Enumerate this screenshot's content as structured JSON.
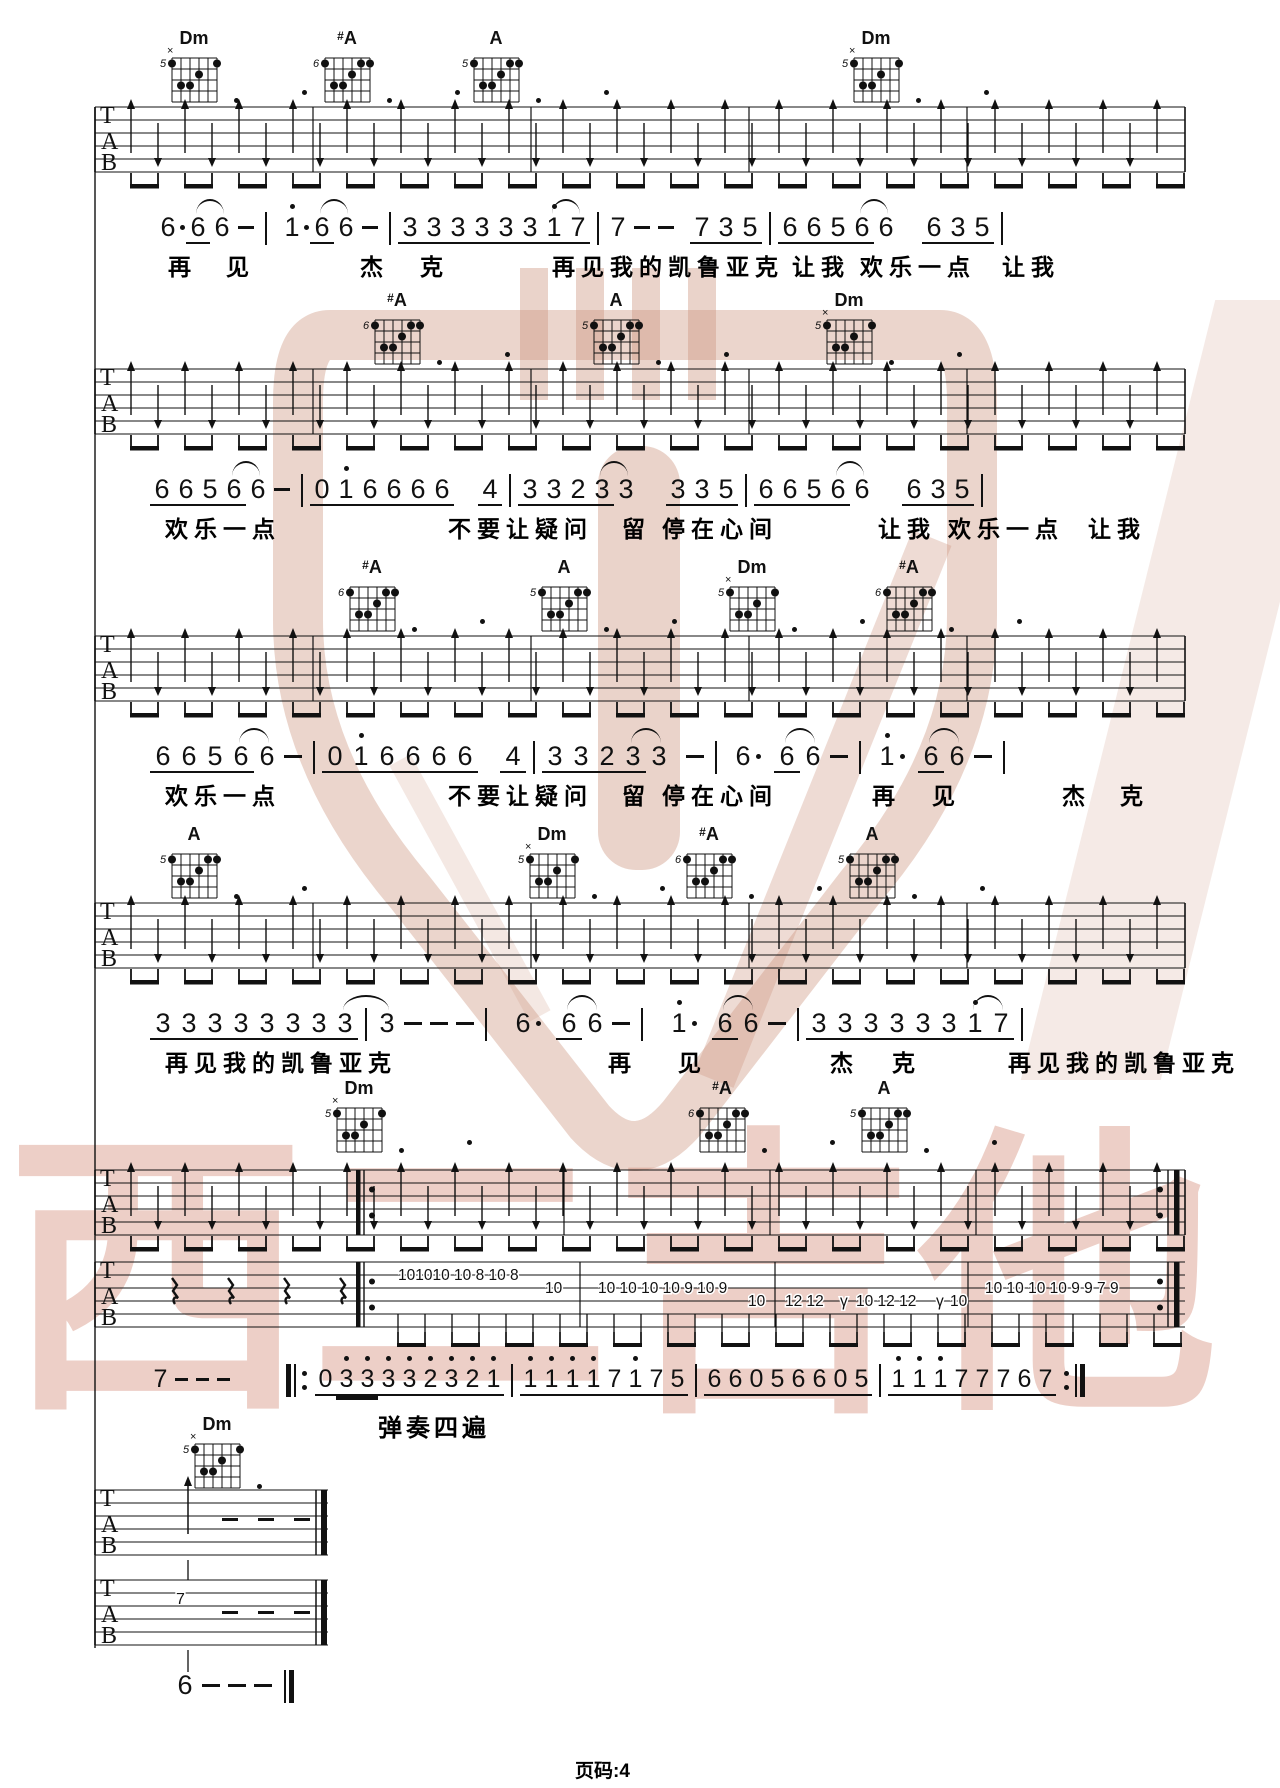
{
  "page": {
    "footer": "页码:4",
    "play_instruction": "弹奏四遍"
  },
  "watermark": {
    "brand_text": "西二吉他"
  },
  "colors": {
    "ink": "#111111",
    "wm_text": "rgba(208,130,108,0.38)",
    "wm_logo": "rgba(205,150,128,0.40)"
  },
  "tab_letters": [
    "T",
    "A",
    "B"
  ],
  "chord_shapes": {
    "Dm": {
      "label": "Dm",
      "fret": "5",
      "muted": true,
      "dots": [
        [
          1,
          1
        ],
        [
          6,
          1
        ],
        [
          4,
          2
        ],
        [
          2,
          3
        ],
        [
          3,
          3
        ]
      ]
    },
    "#A": {
      "label": "#A",
      "fret": "6",
      "muted": false,
      "dots": [
        [
          1,
          1
        ],
        [
          5,
          1
        ],
        [
          6,
          1
        ],
        [
          4,
          2
        ],
        [
          2,
          3
        ],
        [
          3,
          3
        ]
      ]
    },
    "A": {
      "label": "A",
      "fret": "5",
      "muted": false,
      "dots": [
        [
          1,
          1
        ],
        [
          5,
          1
        ],
        [
          6,
          1
        ],
        [
          4,
          2
        ],
        [
          2,
          3
        ],
        [
          3,
          3
        ]
      ]
    }
  },
  "systems": [
    {
      "chord_y": 28,
      "tab_y": 107,
      "not_y": 212,
      "lyr_y": 248,
      "tok_w": 24,
      "chords": [
        {
          "n": "Dm",
          "x": 190
        },
        {
          "n": "#A",
          "x": 343
        },
        {
          "n": "A",
          "x": 492
        },
        {
          "n": "Dm",
          "x": 872
        }
      ],
      "tok": [
        {
          "g": "6",
          "d": 1
        },
        {
          "g": "6",
          "u": 1,
          "tie": 1
        },
        {
          "g": "6"
        },
        {
          "g": "-"
        },
        {
          "b": "|"
        },
        {
          "g": "1",
          "h": 1,
          "d": 1
        },
        {
          "g": "6",
          "u": 1,
          "tie": 1
        },
        {
          "g": "6"
        },
        {
          "g": "-"
        },
        {
          "b": "|"
        },
        {
          "g": "3",
          "u": 1
        },
        {
          "g": "3",
          "u": 1
        },
        {
          "g": "3",
          "u": 1
        },
        {
          "g": "3",
          "u": 1
        },
        {
          "g": "3",
          "u": 1
        },
        {
          "g": "3",
          "u": 1
        },
        {
          "g": "1",
          "h": 1,
          "u": 1,
          "tie": 1
        },
        {
          "g": "7",
          "u": 1
        },
        {
          "b": "|"
        },
        {
          "g": "7"
        },
        {
          "g": "-"
        },
        {
          "g": "-"
        },
        {
          "g": "7",
          "u": 1,
          "gap": 12
        },
        {
          "g": "3",
          "u": 1
        },
        {
          "g": "5",
          "u": 1
        },
        {
          "b": "|"
        },
        {
          "g": "6",
          "u": 1
        },
        {
          "g": "6",
          "u": 1
        },
        {
          "g": "5",
          "u": 1
        },
        {
          "g": "6",
          "u": 1,
          "tie": 1
        },
        {
          "g": "6"
        },
        {
          "g": "6",
          "u": 1,
          "gap": 24
        },
        {
          "g": "3",
          "u": 1
        },
        {
          "g": "5",
          "u": 1
        },
        {
          "b": "|"
        }
      ],
      "lyr": [
        [
          168,
          "再"
        ],
        [
          226,
          "见"
        ],
        [
          360,
          "杰"
        ],
        [
          420,
          "克"
        ],
        [
          552,
          "再见我的凯鲁亚克"
        ],
        [
          792,
          "让我"
        ],
        [
          860,
          "欢乐一点"
        ],
        [
          1002,
          "让我"
        ]
      ]
    },
    {
      "chord_y": 290,
      "tab_y": 369,
      "not_y": 474,
      "lyr_y": 510,
      "tok_w": 24,
      "chords": [
        {
          "n": "#A",
          "x": 393
        },
        {
          "n": "A",
          "x": 612
        },
        {
          "n": "Dm",
          "x": 845
        }
      ],
      "tok": [
        {
          "g": "6",
          "u": 1
        },
        {
          "g": "6",
          "u": 1
        },
        {
          "g": "5",
          "u": 1
        },
        {
          "g": "6",
          "u": 1,
          "tie": 1
        },
        {
          "g": "6"
        },
        {
          "g": "-"
        },
        {
          "b": "|"
        },
        {
          "g": "0",
          "u": 1
        },
        {
          "g": "1",
          "h": 1,
          "u": 1
        },
        {
          "g": "6",
          "u": 1
        },
        {
          "g": "6",
          "u": 1
        },
        {
          "g": "6",
          "u": 1
        },
        {
          "g": "6",
          "u": 1
        },
        {
          "g": "4",
          "u": 1,
          "gap": 24
        },
        {
          "b": "|"
        },
        {
          "g": "3",
          "u": 1
        },
        {
          "g": "3",
          "u": 1
        },
        {
          "g": "2",
          "u": 1
        },
        {
          "g": "3",
          "u": 1,
          "tie": 1
        },
        {
          "g": "3"
        },
        {
          "g": "3",
          "u": 1,
          "gap": 28
        },
        {
          "g": "3",
          "u": 1
        },
        {
          "g": "5",
          "u": 1
        },
        {
          "b": "|"
        },
        {
          "g": "6",
          "u": 1
        },
        {
          "g": "6",
          "u": 1
        },
        {
          "g": "5",
          "u": 1
        },
        {
          "g": "6",
          "u": 1,
          "tie": 1
        },
        {
          "g": "6"
        },
        {
          "g": "6",
          "u": 1,
          "gap": 28
        },
        {
          "g": "3",
          "u": 1
        },
        {
          "g": "5",
          "u": 1
        },
        {
          "b": "|"
        }
      ],
      "lyr": [
        [
          165,
          "欢乐一点"
        ],
        [
          448,
          "不要让疑问"
        ],
        [
          622,
          "留"
        ],
        [
          662,
          "停在心间"
        ],
        [
          878,
          "让我"
        ],
        [
          948,
          "欢乐一点"
        ],
        [
          1088,
          "让我"
        ]
      ]
    },
    {
      "chord_y": 557,
      "tab_y": 636,
      "not_y": 741,
      "lyr_y": 777,
      "tok_w": 26,
      "chords": [
        {
          "n": "#A",
          "x": 368
        },
        {
          "n": "A",
          "x": 560
        },
        {
          "n": "Dm",
          "x": 748
        },
        {
          "n": "#A",
          "x": 905
        }
      ],
      "tok": [
        {
          "g": "6",
          "u": 1
        },
        {
          "g": "6",
          "u": 1
        },
        {
          "g": "5",
          "u": 1
        },
        {
          "g": "6",
          "u": 1,
          "tie": 1
        },
        {
          "g": "6"
        },
        {
          "g": "-"
        },
        {
          "b": "|"
        },
        {
          "g": "0",
          "u": 1
        },
        {
          "g": "1",
          "h": 1,
          "u": 1
        },
        {
          "g": "6",
          "u": 1
        },
        {
          "g": "6",
          "u": 1
        },
        {
          "g": "6",
          "u": 1
        },
        {
          "g": "6",
          "u": 1
        },
        {
          "g": "4",
          "u": 1,
          "gap": 22
        },
        {
          "b": "|"
        },
        {
          "g": "3",
          "u": 1
        },
        {
          "g": "3",
          "u": 1
        },
        {
          "g": "2",
          "u": 1
        },
        {
          "g": "3",
          "u": 1,
          "tie": 1
        },
        {
          "g": "3"
        },
        {
          "g": "-",
          "gap": 10
        },
        {
          "b": "|"
        },
        {
          "g": "6",
          "d": 1
        },
        {
          "g": "6",
          "u": 1,
          "tie": 1,
          "gap": 12
        },
        {
          "g": "6"
        },
        {
          "g": "-"
        },
        {
          "b": "|"
        },
        {
          "g": "1",
          "h": 1,
          "d": 1
        },
        {
          "g": "6",
          "u": 1,
          "tie": 1,
          "gap": 12
        },
        {
          "g": "6"
        },
        {
          "g": "-"
        },
        {
          "b": "|"
        }
      ],
      "lyr": [
        [
          165,
          "欢乐一点"
        ],
        [
          448,
          "不要让疑问"
        ],
        [
          622,
          "留"
        ],
        [
          662,
          "停在心间"
        ],
        [
          872,
          "再"
        ],
        [
          932,
          "见"
        ],
        [
          1062,
          "杰"
        ],
        [
          1120,
          "克"
        ]
      ]
    },
    {
      "chord_y": 824,
      "tab_y": 903,
      "not_y": 1008,
      "lyr_y": 1044,
      "tok_w": 26,
      "chords": [
        {
          "n": "A",
          "x": 190
        },
        {
          "n": "Dm",
          "x": 548
        },
        {
          "n": "#A",
          "x": 705
        },
        {
          "n": "A",
          "x": 868
        }
      ],
      "tok": [
        {
          "g": "3",
          "u": 1
        },
        {
          "g": "3",
          "u": 1
        },
        {
          "g": "3",
          "u": 1
        },
        {
          "g": "3",
          "u": 1
        },
        {
          "g": "3",
          "u": 1
        },
        {
          "g": "3",
          "u": 1
        },
        {
          "g": "3",
          "u": 1
        },
        {
          "g": "3",
          "u": 1,
          "tie": 1
        },
        {
          "b": "|"
        },
        {
          "g": "3"
        },
        {
          "g": "-"
        },
        {
          "g": "-"
        },
        {
          "g": "-"
        },
        {
          "b": "|"
        },
        {
          "g": "6",
          "d": 1,
          "gap": 10
        },
        {
          "g": "6",
          "u": 1,
          "tie": 1,
          "gap": 14
        },
        {
          "g": "6"
        },
        {
          "g": "-"
        },
        {
          "b": "|"
        },
        {
          "g": "1",
          "h": 1,
          "d": 1,
          "gap": 10
        },
        {
          "g": "6",
          "u": 1,
          "tie": 1,
          "gap": 14
        },
        {
          "g": "6"
        },
        {
          "g": "-"
        },
        {
          "b": "|"
        },
        {
          "g": "3",
          "u": 1
        },
        {
          "g": "3",
          "u": 1
        },
        {
          "g": "3",
          "u": 1
        },
        {
          "g": "3",
          "u": 1
        },
        {
          "g": "3",
          "u": 1
        },
        {
          "g": "3",
          "u": 1
        },
        {
          "g": "1",
          "h": 1,
          "u": 1,
          "tie": 1
        },
        {
          "g": "7",
          "u": 1
        },
        {
          "b": "|"
        }
      ],
      "lyr": [
        [
          165,
          "再见我的凯鲁亚克"
        ],
        [
          608,
          "再"
        ],
        [
          678,
          "见"
        ],
        [
          830,
          "杰"
        ],
        [
          892,
          "克"
        ],
        [
          1008,
          "再见我的凯鲁亚克"
        ]
      ]
    },
    {
      "chord_y": 1078,
      "tab_y": 1170,
      "not_y": 1364,
      "lyr_y": 0,
      "tok_w": 21,
      "tab_repeat": true,
      "chords": [
        {
          "n": "Dm",
          "x": 355
        },
        {
          "n": "#A",
          "x": 718
        },
        {
          "n": "A",
          "x": 880
        }
      ],
      "tok": [
        {
          "g": "7"
        },
        {
          "g": "-"
        },
        {
          "g": "-"
        },
        {
          "g": "-"
        },
        {
          "b": "|:",
          "gap": 52
        },
        {
          "g": "0",
          "u": 1
        },
        {
          "g": "3",
          "h": 1,
          "u": 2
        },
        {
          "g": "3",
          "h": 1,
          "u": 2
        },
        {
          "g": "3",
          "h": 1,
          "u": 1
        },
        {
          "g": "3",
          "h": 1,
          "u": 1
        },
        {
          "g": "2",
          "h": 1,
          "u": 1
        },
        {
          "g": "3",
          "h": 1,
          "u": 1
        },
        {
          "g": "2",
          "h": 1,
          "u": 1
        },
        {
          "g": "1",
          "h": 1,
          "u": 1
        },
        {
          "b": "|"
        },
        {
          "g": "1",
          "h": 1,
          "u": 1
        },
        {
          "g": "1",
          "h": 1,
          "u": 1
        },
        {
          "g": "1",
          "h": 1,
          "u": 1
        },
        {
          "g": "1",
          "h": 1,
          "u": 1
        },
        {
          "g": "7",
          "u": 1
        },
        {
          "g": "1",
          "h": 1,
          "u": 1
        },
        {
          "g": "7",
          "u": 1
        },
        {
          "g": "5",
          "u": 1
        },
        {
          "b": "|"
        },
        {
          "g": "6",
          "u": 1
        },
        {
          "g": "6",
          "u": 1
        },
        {
          "g": "0",
          "u": 1
        },
        {
          "g": "5",
          "u": 1
        },
        {
          "g": "6",
          "u": 1
        },
        {
          "g": "6",
          "u": 1
        },
        {
          "g": "0",
          "u": 1
        },
        {
          "g": "5",
          "u": 1
        },
        {
          "b": "|"
        },
        {
          "g": "1",
          "h": 1,
          "u": 1
        },
        {
          "g": "1",
          "h": 1,
          "u": 1
        },
        {
          "g": "1",
          "h": 1,
          "u": 1
        },
        {
          "g": "7",
          "u": 1
        },
        {
          "g": "7",
          "u": 1
        },
        {
          "g": "7",
          "u": 1
        },
        {
          "g": "6",
          "u": 1
        },
        {
          "g": "7",
          "u": 1
        },
        {
          "b": ":|"
        }
      ],
      "lyr": []
    }
  ],
  "melody_tab": {
    "top": 1262,
    "bars": [
      580,
      775,
      968
    ],
    "repeat_in": 358,
    "repeat_out": true,
    "rests": [
      172,
      228,
      284,
      340
    ],
    "items": [
      [
        398,
        1,
        "101010 10 8 10 8"
      ],
      [
        545,
        2,
        "10"
      ],
      [
        598,
        2,
        "10 10 10 10 9 10 9"
      ],
      [
        748,
        3,
        "10"
      ],
      [
        785,
        3,
        "12 12"
      ],
      [
        840,
        3,
        "γ"
      ],
      [
        856,
        3,
        "10 12 12"
      ],
      [
        936,
        3,
        "γ"
      ],
      [
        950,
        3,
        "10"
      ],
      [
        985,
        2,
        "10 10 10 10 9 9 7 9"
      ]
    ]
  },
  "tail": {
    "chord": {
      "n": "Dm",
      "x": 213,
      "y": 1414
    },
    "staff1": {
      "top": 1490,
      "arrow_x": 188,
      "dashes": [
        222,
        258,
        294
      ]
    },
    "staff2": {
      "top": 1580,
      "seven": "7",
      "seven_x": 176,
      "dashes": [
        222,
        258,
        294
      ]
    },
    "end_x": 172,
    "end_y": 1670,
    "end_tok": [
      {
        "g": "6"
      },
      {
        "g": "-"
      },
      {
        "g": "-"
      },
      {
        "g": "-"
      },
      {
        "b": "||"
      }
    ]
  }
}
